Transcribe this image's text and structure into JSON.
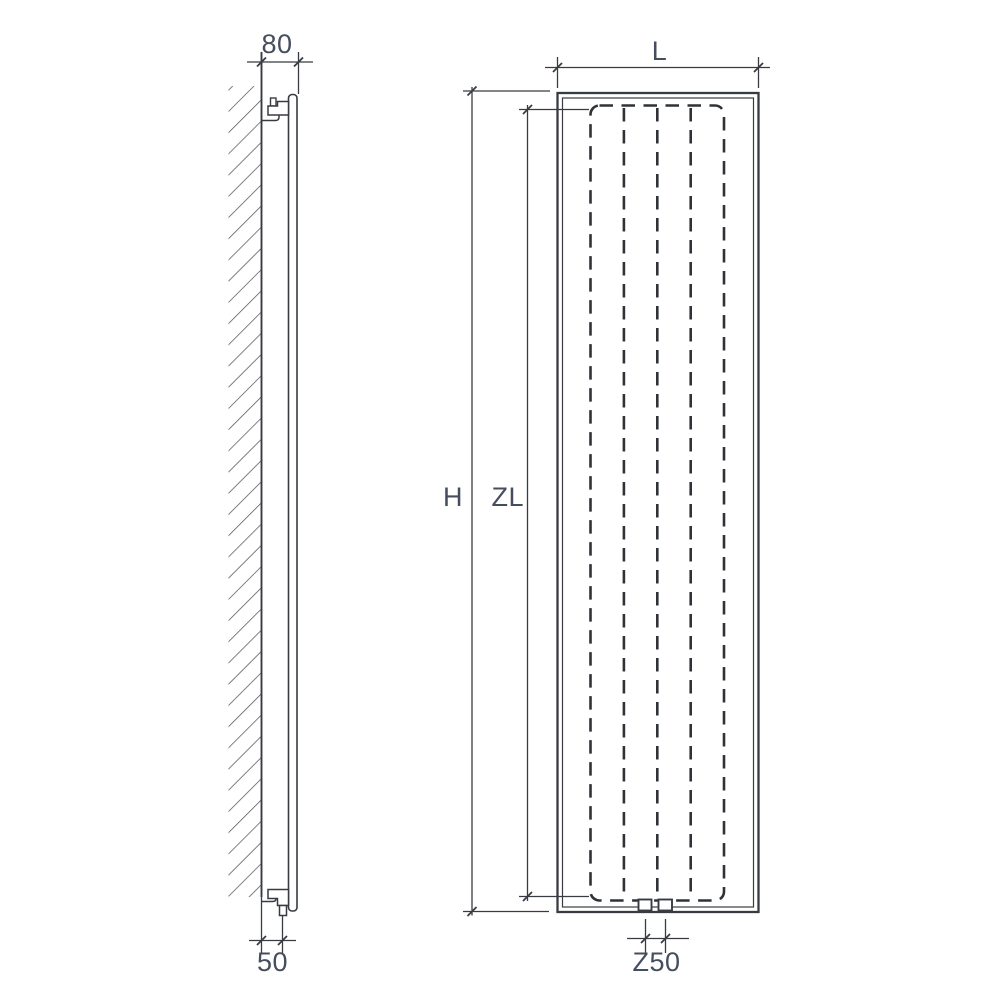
{
  "page": {
    "background": "#ffffff"
  },
  "drawing": {
    "description": "Technical dimension drawing of a vertical panel radiator: wall-mounted side view and front view with hidden-line heating element",
    "colors": {
      "line": "#383c42",
      "line_bold": "#2f3338",
      "hatch": "#51565c",
      "label": "#454e5e",
      "background": "#ffffff"
    },
    "side_view": {
      "dim_wall_to_front": "80",
      "dim_wall_to_connection": "50"
    },
    "front_view": {
      "dim_width": "L",
      "dim_height": "H",
      "dim_element_height": "ZL",
      "dim_connection_centers": "Z50"
    }
  }
}
